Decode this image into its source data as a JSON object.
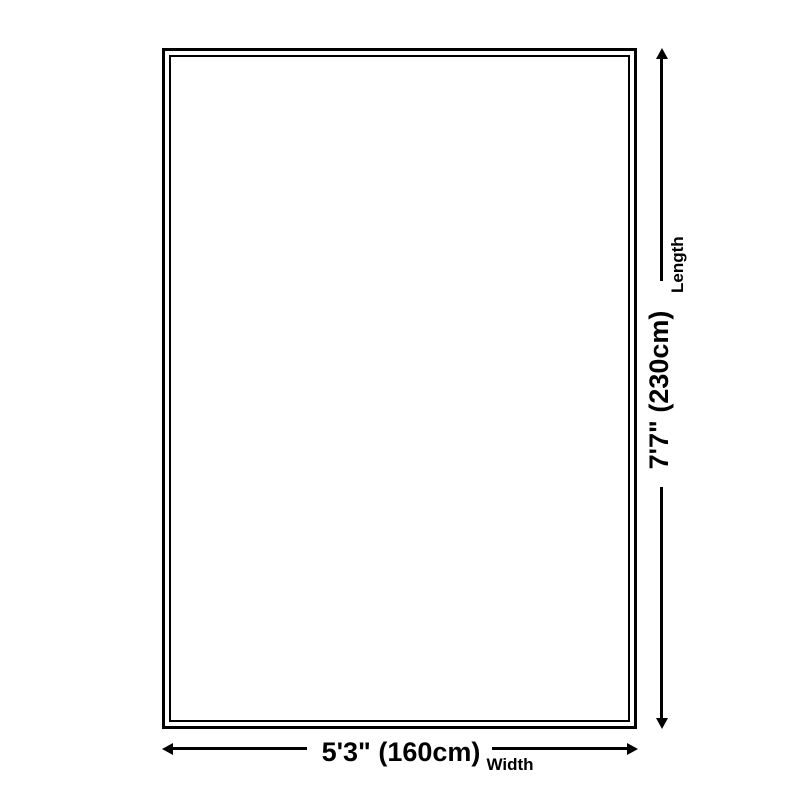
{
  "diagram": {
    "type": "product-dimension-diagram",
    "shape": "rectangle-double-outline",
    "length": {
      "value": "7'7\" (230cm)",
      "label": "Length",
      "arrow": "vertical-double-headed-arrow"
    },
    "width": {
      "value": "5'3\" (160cm)",
      "label": "Width",
      "arrow": "horizontal-double-headed-arrow"
    },
    "colors": {
      "line": "#000000",
      "text": "#000000",
      "background": "#ffffff"
    }
  }
}
